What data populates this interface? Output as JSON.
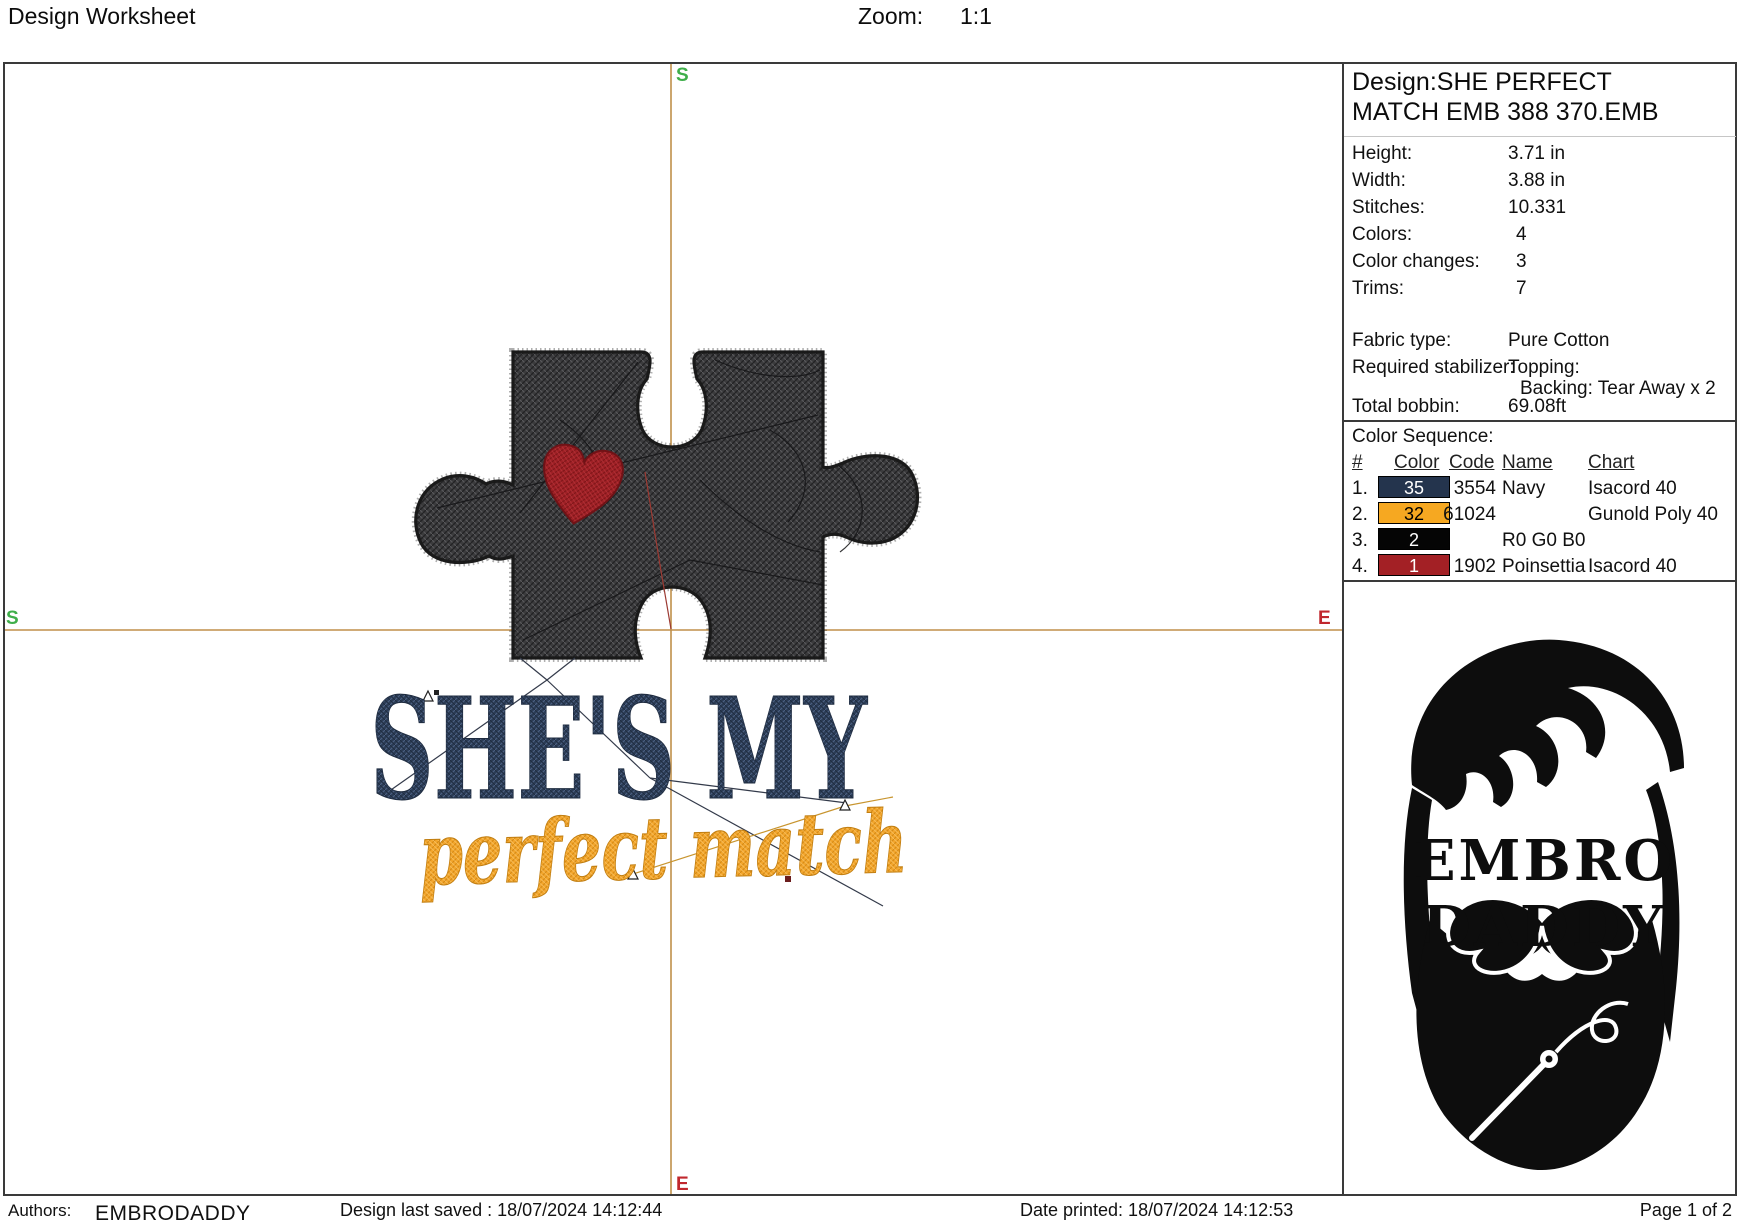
{
  "header": {
    "title": "Design Worksheet",
    "zoom_label": "Zoom:",
    "zoom_value": "1:1"
  },
  "axes": {
    "start_label": "S",
    "end_label": "E"
  },
  "colors": {
    "axis": "#c08f4a",
    "marker_start": "#3fae4a",
    "marker_end": "#c0272d",
    "navy_thread": "#2b3c55",
    "gold_thread": "#efa01f",
    "puzzle_fill": "#3b3b3d",
    "heart_fill": "#9e2025",
    "logo_ink": "#0d0d0d"
  },
  "artwork": {
    "line1": "SHE'S MY",
    "line2": "perfect match"
  },
  "design_panel": {
    "title_line1": "Design:SHE PERFECT",
    "title_line2": "MATCH EMB 388 370.EMB",
    "details": [
      {
        "label": "Height:",
        "value": "3.71 in"
      },
      {
        "label": "Width:",
        "value": "3.88 in"
      },
      {
        "label": "Stitches:",
        "value": "10.331"
      },
      {
        "label": "Colors:",
        "value": "4"
      },
      {
        "label": "Color changes:",
        "value": "3"
      },
      {
        "label": "Trims:",
        "value": "7"
      }
    ],
    "fabric": {
      "label": "Fabric type:",
      "value": "Pure Cotton"
    },
    "stabilizer": {
      "label": "Required stabilizer:",
      "value": "Topping:",
      "value2": "Backing: Tear Away x 2"
    },
    "bobbin": {
      "label": "Total bobbin:",
      "value": "69.08ft"
    },
    "color_sequence": {
      "title": "Color Sequence:",
      "columns": {
        "num": "#",
        "color": "Color",
        "code": "Code",
        "name": "Name",
        "chart": "Chart"
      },
      "rows": [
        {
          "num": "1.",
          "swatch": "35",
          "swatch_color": "#24344d",
          "swatch_text_color": "#ffffff",
          "code": "3554",
          "name": "Navy",
          "chart": "Isacord 40"
        },
        {
          "num": "2.",
          "swatch": "32",
          "swatch_color": "#f6a821",
          "swatch_text_color": "#000000",
          "code": "61024",
          "name": "",
          "chart": "Gunold Poly 40"
        },
        {
          "num": "3.",
          "swatch": "2",
          "swatch_color": "#050505",
          "swatch_text_color": "#ffffff",
          "code": "",
          "name": "R0 G0 B0",
          "chart": ""
        },
        {
          "num": "4.",
          "swatch": "1",
          "swatch_color": "#a32025",
          "swatch_text_color": "#ffffff",
          "code": "1902",
          "name": "Poinsettia",
          "chart": "Isacord 40"
        }
      ]
    }
  },
  "logo": {
    "line1": "EMBRO",
    "line2": "DADDY"
  },
  "footer": {
    "authors_label": "Authors:",
    "authors_value": "EMBRODADDY",
    "saved": "Design last saved : 18/07/2024 14:12:44",
    "printed": "Date printed: 18/07/2024 14:12:53",
    "page": "Page 1 of 2"
  }
}
